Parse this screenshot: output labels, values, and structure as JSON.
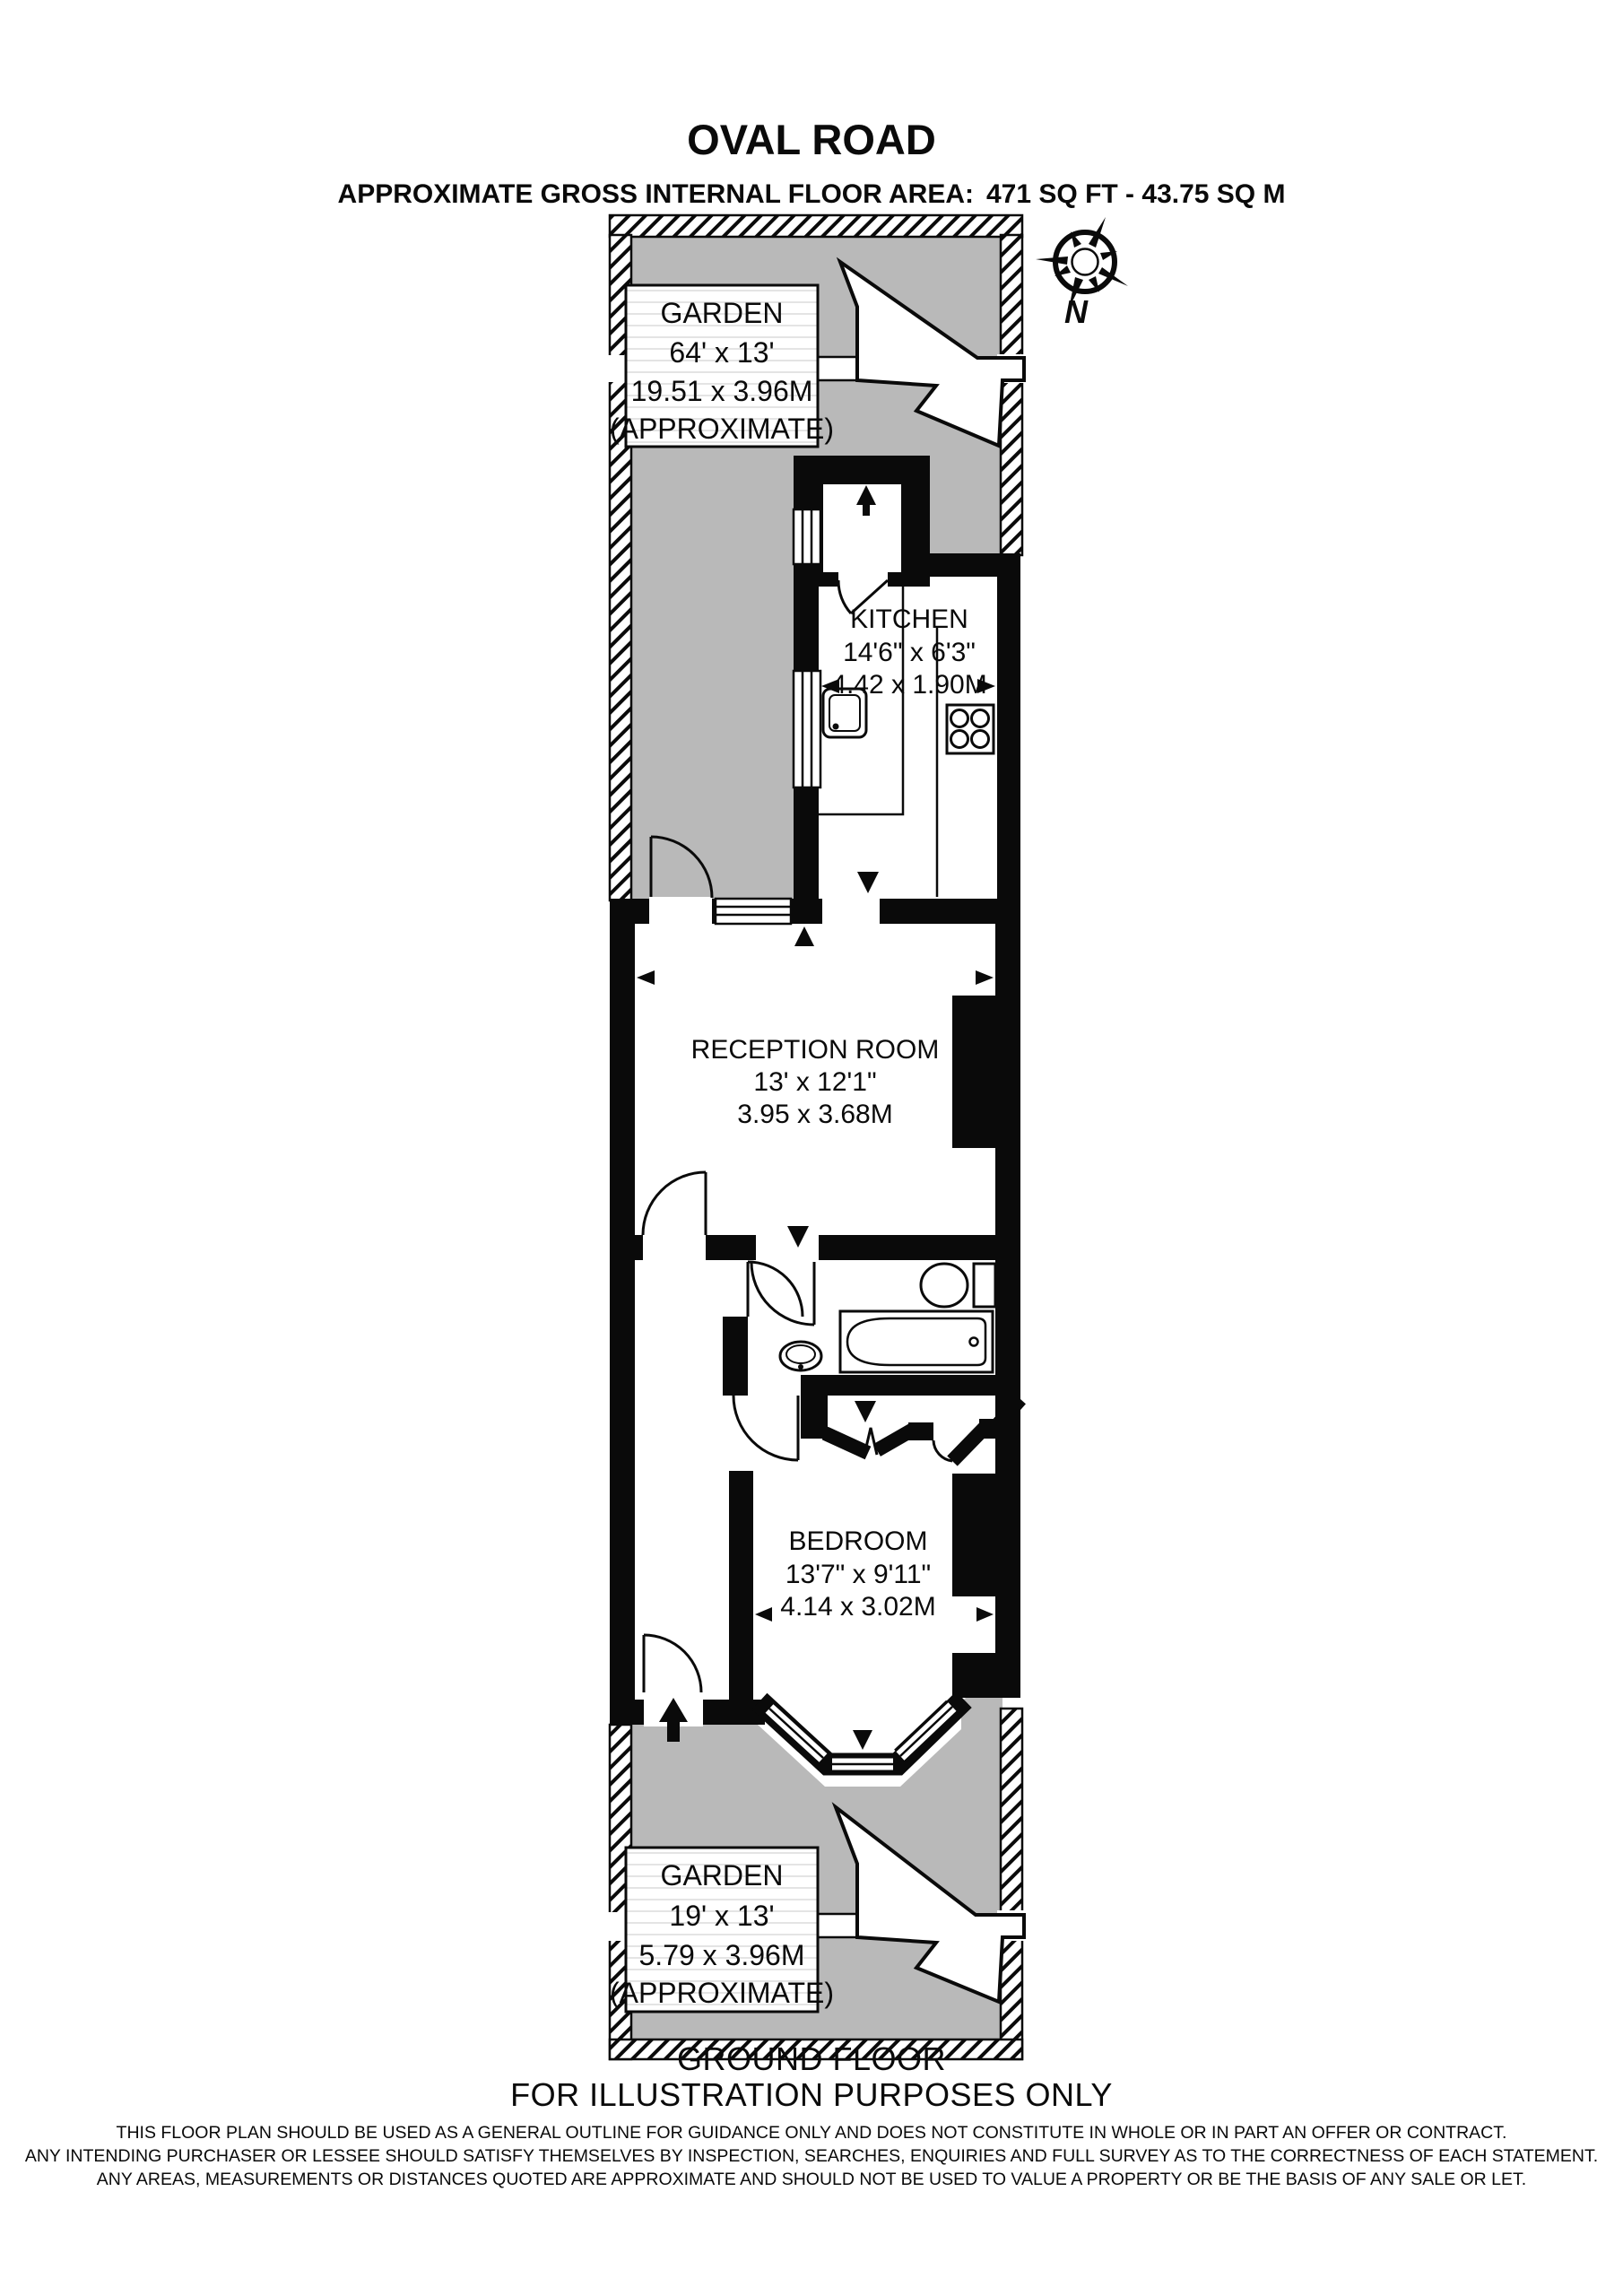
{
  "header": {
    "title": "OVAL ROAD",
    "area_label": "APPROXIMATE GROSS INTERNAL FLOOR AREA:",
    "area_value": "471 SQ FT - 43.75 SQ M"
  },
  "compass": {
    "north_label": "N"
  },
  "rooms": {
    "garden_top": {
      "name": "GARDEN",
      "size_imperial": "64' x 13'",
      "size_metric": "19.51 x 3.96M",
      "note": "(APPROXIMATE)"
    },
    "kitchen": {
      "name": "KITCHEN",
      "size_imperial": "14'6\" x 6'3\"",
      "size_metric": "4.42 x 1.90M"
    },
    "reception": {
      "name": "RECEPTION ROOM",
      "size_imperial": "13' x 12'1\"",
      "size_metric": "3.95 x 3.68M"
    },
    "bedroom": {
      "name": "BEDROOM",
      "size_imperial": "13'7\" x 9'11\"",
      "size_metric": "4.14 x 3.02M"
    },
    "garden_bottom": {
      "name": "GARDEN",
      "size_imperial": "19' x 13'",
      "size_metric": "5.79 x 3.96M",
      "note": "(APPROXIMATE)"
    }
  },
  "footer": {
    "floor_label": "GROUND FLOOR",
    "illustration_note": "FOR ILLUSTRATION PURPOSES ONLY",
    "disclaimer_line1": "THIS FLOOR PLAN SHOULD BE USED AS A GENERAL OUTLINE FOR GUIDANCE ONLY AND DOES NOT CONSTITUTE IN WHOLE OR IN PART AN OFFER OR CONTRACT.",
    "disclaimer_line2": "ANY INTENDING PURCHASER OR LESSEE SHOULD SATISFY THEMSELVES BY INSPECTION, SEARCHES, ENQUIRIES AND FULL SURVEY AS TO THE CORRECTNESS OF EACH STATEMENT.",
    "disclaimer_line3": "ANY AREAS, MEASUREMENTS OR DISTANCES QUOTED ARE APPROXIMATE AND SHOULD NOT BE USED TO VALUE A PROPERTY OR BE THE BASIS OF ANY SALE OR LET."
  },
  "colors": {
    "garden_fill": "#b9b9b9",
    "wall": "#0a0a0a",
    "background": "#ffffff"
  }
}
